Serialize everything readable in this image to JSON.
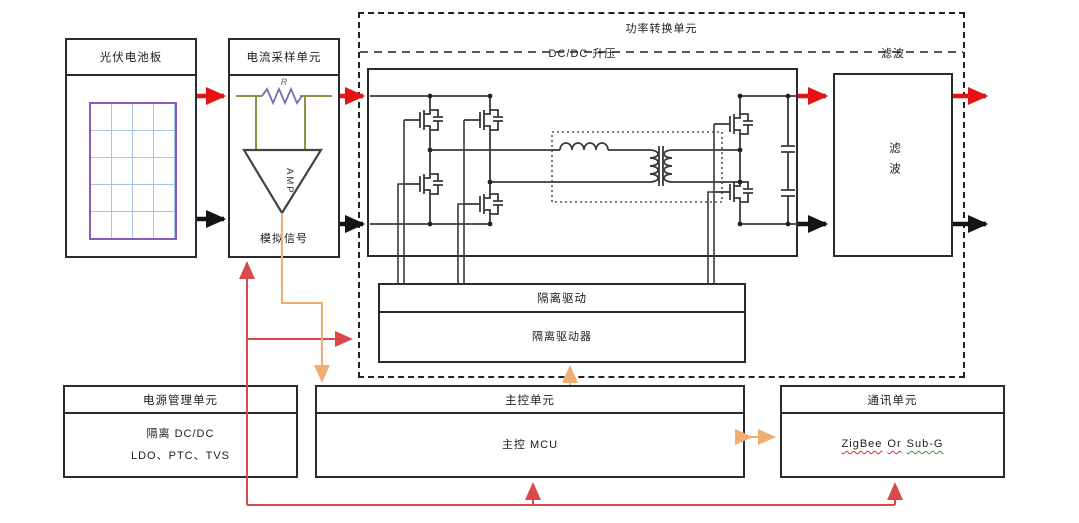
{
  "colors": {
    "flow_red": "#e41414",
    "flow_black": "#141414",
    "power_line_red": "#d84a4a",
    "signal_orange": "#efae72",
    "box_border": "#2b2b2b",
    "pv_panel_purple": "#8a5bb8",
    "pv_grid_blue": "#a9c4ea",
    "shunt_wire_olive": "#8f8f45",
    "shunt_zigzag_purple": "#7b6bb5"
  },
  "blocks": {
    "pv": {
      "title": "光伏电池板"
    },
    "current_sampling": {
      "title": "电流采样单元",
      "amp_label": "AMP",
      "resistor_label": "R",
      "output_label": "模拟信号"
    },
    "power_conversion": {
      "title": "功率转换单元",
      "dcdc": {
        "title": "DC/DC 升压"
      },
      "filter": {
        "title": "滤波",
        "body": "滤波"
      },
      "isolated_drive": {
        "top_label": "隔离驱动",
        "bottom_label": "隔离驱动器"
      }
    },
    "power_management": {
      "title": "电源管理单元",
      "line1": "隔离 DC/DC",
      "line2": "LDO、PTC、TVS"
    },
    "main_control": {
      "title": "主控单元",
      "body": "主控 MCU"
    },
    "communication": {
      "title": "通讯单元",
      "radio1": "ZigBee",
      "conj": "Or",
      "radio2": "Sub-G"
    }
  }
}
